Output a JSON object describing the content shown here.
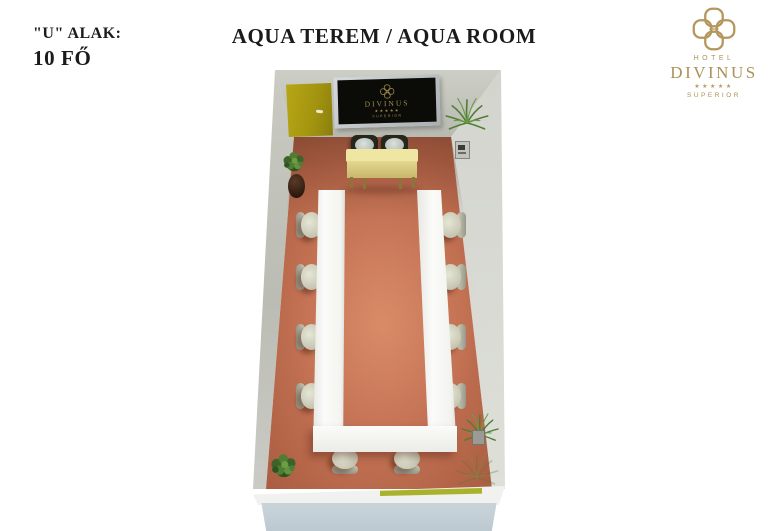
{
  "header": {
    "layout_label": "\"U\" ALAK:",
    "capacity": "10 FŐ",
    "title": "AQUA TEREM / AQUA ROOM"
  },
  "logo": {
    "hotel": "HOTEL",
    "name": "DIVINUS",
    "stars": "★★★★★",
    "tier": "SUPERIOR",
    "color": "#ab9156"
  },
  "screen": {
    "name": "DIVINUS",
    "stars": "★★★★★",
    "tier": "SUPERIOR",
    "logo_color": "#a5904e"
  },
  "room": {
    "floor_color": "#bf6e50",
    "wall_color": "#c5c6be",
    "door_color": "#a89a12",
    "u_table_color": "#f4f4f0",
    "head_table_color": "#e9e0a0",
    "chair_color": "#d4d4c2",
    "seats": {
      "left": 4,
      "right": 4,
      "bottom": 2,
      "total": 10
    }
  }
}
